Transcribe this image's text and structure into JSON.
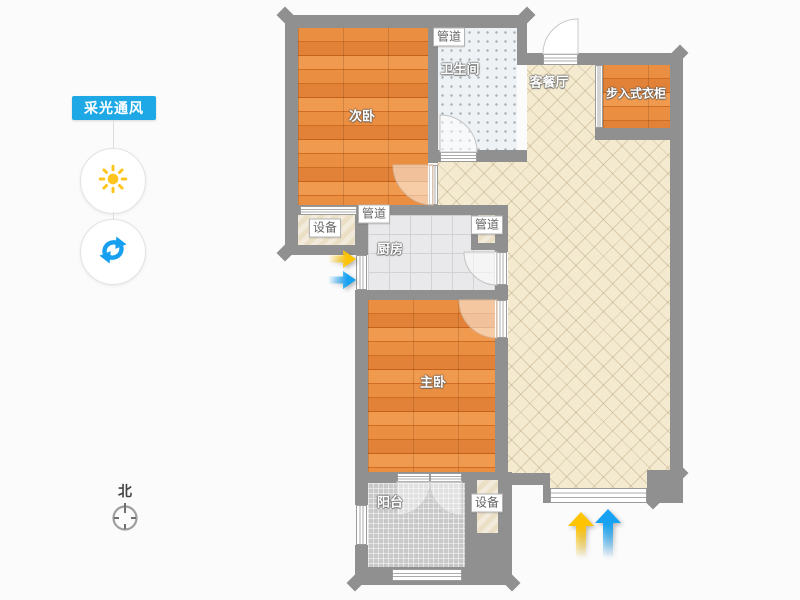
{
  "sidebar": {
    "toggle_label": "采光通风",
    "icons": {
      "sun": "sun-icon",
      "refresh": "refresh-icon"
    }
  },
  "compass": {
    "north_label": "北"
  },
  "floorplan": {
    "rooms": {
      "secondary_bedroom": "次卧",
      "bathroom": "卫生间",
      "living_dining": "客餐厅",
      "walkin_closet": "步入式衣柜",
      "kitchen": "厨房",
      "master_bedroom": "主卧",
      "balcony": "阳台"
    },
    "tags": {
      "duct": "管道",
      "equipment": "设备"
    }
  },
  "colors": {
    "accent_blue": "#1ea9e6",
    "sun_yellow": "#ffc41e",
    "refresh_blue": "#18a0f0",
    "arrow_lighting_yellow": "#ffc400",
    "arrow_ventilation_blue": "#16a2f3",
    "wall_gray": "#909090"
  }
}
